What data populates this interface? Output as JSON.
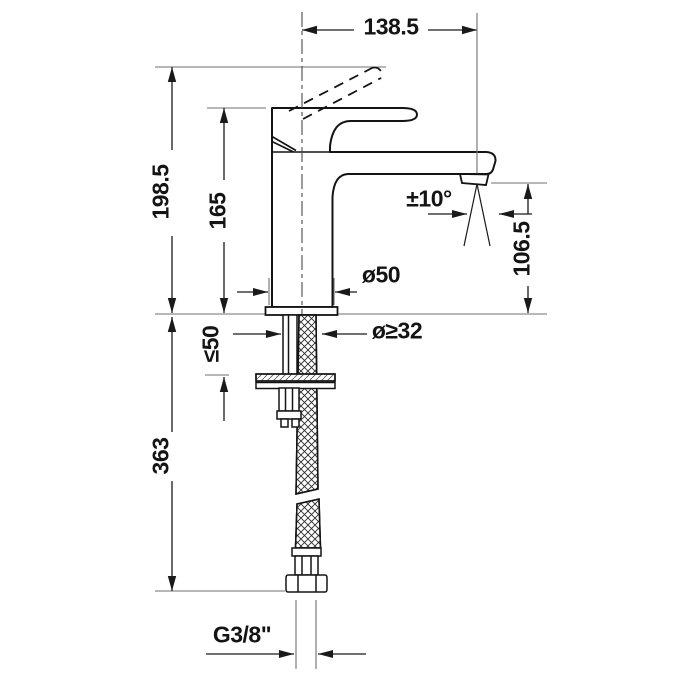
{
  "drawing_type": "technical-dimension-drawing",
  "subject": "single-lever basin mixer faucet, side elevation with flexible supply hose",
  "dimensions": {
    "spout_reach": "138.5",
    "total_height": "198.5",
    "handle_height": "165",
    "spout_angle": "±10°",
    "outlet_height": "106.5",
    "body_diameter": "ø50",
    "hole_diameter": "ø≥32",
    "deck_thickness": "≤50",
    "hose_length": "363",
    "connection_thread": "G3/8\""
  },
  "colors": {
    "background": "#ffffff",
    "outline": "#141414",
    "dimension_line": "#1a1a1a",
    "extension_line": "#6f6f6f",
    "center_line": "#4a4a4a"
  }
}
